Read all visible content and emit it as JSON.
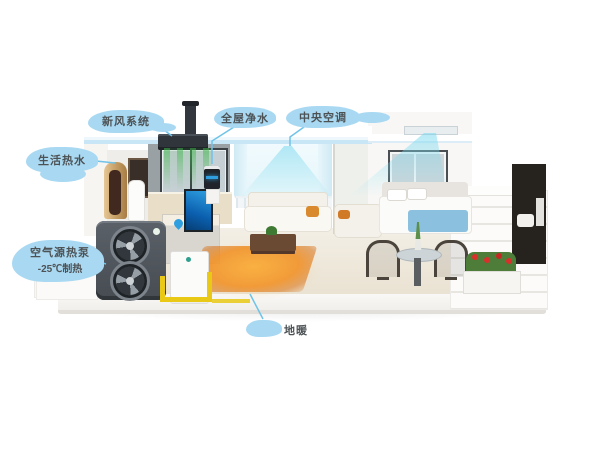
{
  "canvas": {
    "width": 600,
    "height": 450
  },
  "colors": {
    "bubble": "#a9d9f2",
    "bubbleText": "#4d5255",
    "line": "#6fc3e8",
    "coolAir": "#7ad8ee",
    "freshAir": "#3eb54a",
    "floorHeat": "#ef8a1c",
    "pipe": "#e9c816",
    "unitBody": "#50565d",
    "tankGold": "#c9a36b",
    "accentBlue": "#2f9fe0"
  },
  "callouts": [
    {
      "id": "fresh-air",
      "label": "新风系统"
    },
    {
      "id": "water-purifier",
      "label": "全屋净水"
    },
    {
      "id": "central-ac",
      "label": "中央空调"
    },
    {
      "id": "hot-water",
      "label": "生活热水"
    },
    {
      "id": "heat-pump",
      "label": "空气源热泵",
      "sublabel": "-25℃制热"
    },
    {
      "id": "floor-heating",
      "label": "地暖"
    }
  ],
  "icons": {
    "water_drop_icon": "droplet"
  }
}
